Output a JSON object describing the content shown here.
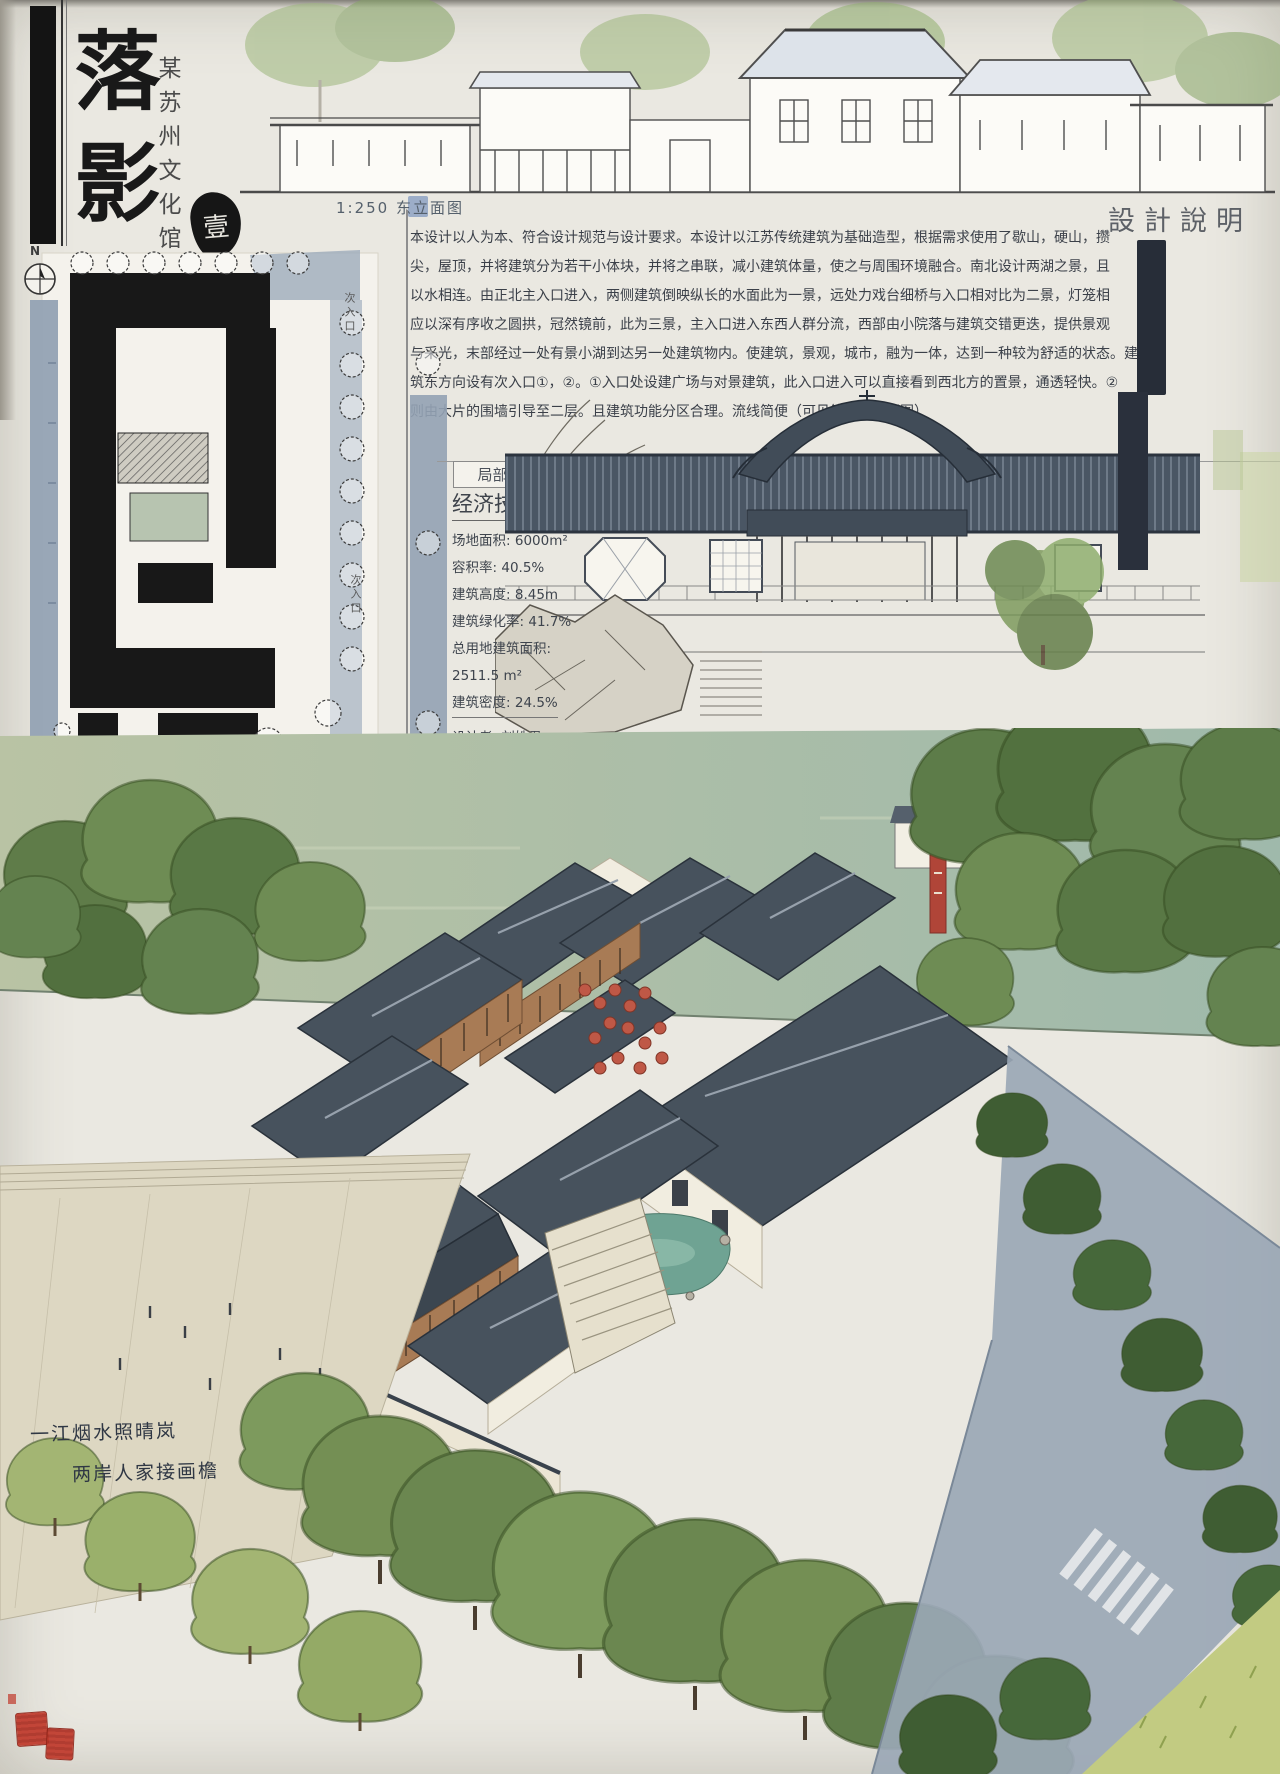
{
  "board": {
    "title": "落影",
    "subtitle": "某苏州文化馆",
    "index_seal": "壹"
  },
  "east_elevation": {
    "caption": "1:250 东立面图"
  },
  "design_notes": {
    "header": "設計說明",
    "lines": [
      "本设计以人为本、符合设计规范与设计要求。本设计以江苏传统建筑为基础造型，根据需求使用了歇山，硬山，攒",
      "尖，屋顶，并将建筑分为若干小体块，并将之串联，减小建筑体量，使之与周围环境融合。南北设计两湖之景，且",
      "以水相连。由正北主入口进入，两侧建筑倒映纵长的水面此为一景，远处力戏台细桥与入口相对比为二景，灯笼相",
      "应以深有序收之圆拱，冠然镜前，此为三景，主入口进入东西人群分流，西部由小院落与建筑交错更迭，提供景观",
      "与采光，末部经过一处有景小湖到达另一处建筑物内。使建筑，景观，城市，融为一体，达到一种较为舒适的状态。建",
      "筑东方向设有次入口①，②。①入口处设建广场与对景建筑，此入口进入可以直接看到西北方的置景，通透轻快。②",
      "则由大片的围墙引导至二层。且建筑功能分区合理。流线简便（可见第二张介绍图）"
    ]
  },
  "site_plan": {
    "north_label": "N",
    "secondary_entrance_label": "次入口",
    "main_entrance_label": "主入口",
    "caption": "1:500 总平面图"
  },
  "partial_elevation": {
    "caption": "局部立面图"
  },
  "indicators": {
    "header": "经济技术指标",
    "rows": [
      {
        "label": "场地面积:",
        "value": "6000m²"
      },
      {
        "label": "容积率:",
        "value": "40.5%"
      },
      {
        "label": "建筑高度:",
        "value": "8.45m"
      },
      {
        "label": "建筑绿化率:",
        "value": "41.7%"
      },
      {
        "label": "总用地建筑面积:",
        "value": ""
      },
      {
        "label": "",
        "value": "2511.5 m²"
      },
      {
        "label": "建筑密度:",
        "value": "24.5%"
      }
    ],
    "credits": [
      {
        "label": "设计者:",
        "value": "刘姝君"
      },
      {
        "label": "",
        "value": "20172212310234"
      },
      {
        "label": "指导老师:",
        "value": "易彰"
      },
      {
        "label": "古月新",
        "value": "2019.6"
      }
    ]
  },
  "perspective": {
    "poem": [
      "一江烟水照晴岚",
      "两岸人家接画檐"
    ]
  },
  "colors": {
    "paper": "#eae8e1",
    "ink": "#141414",
    "road_wash": "#93a2b4",
    "water_wash": "#aebfa8",
    "pond": "#6fa393",
    "roof_slate": "#47525d",
    "wood": "#a87b55",
    "lantern_red": "#bf5846",
    "tree_green": "#6d8a52",
    "grass": "#c2cb82",
    "seal_red": "#c0392b"
  }
}
